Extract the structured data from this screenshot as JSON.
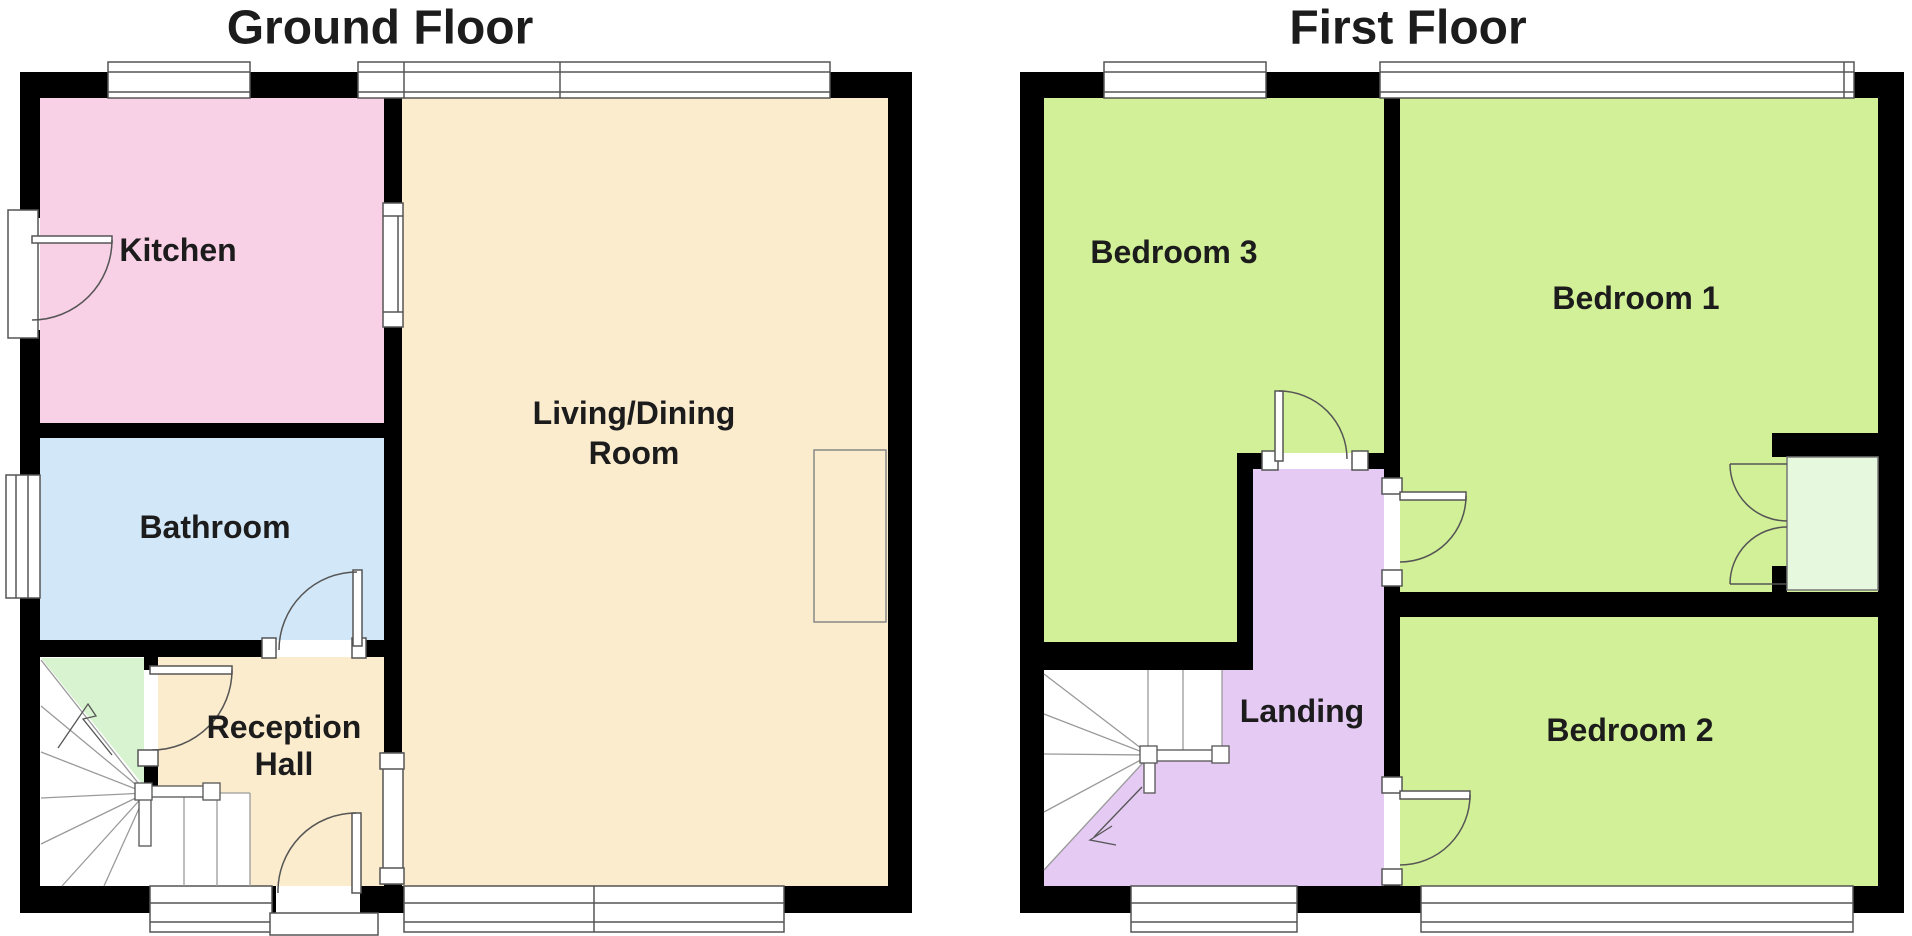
{
  "ground": {
    "title": "Ground Floor",
    "rooms": {
      "kitchen": {
        "label": "Kitchen",
        "color": "#f8d1e7"
      },
      "bathroom": {
        "label": "Bathroom",
        "color": "#d2e7f7"
      },
      "living_dining": {
        "label_line1": "Living/Dining",
        "label_line2": "Room",
        "color": "#fbeccd"
      },
      "reception_hall": {
        "label_line1": "Reception",
        "label_line2": "Hall",
        "color": "#fbeccd"
      }
    },
    "stairs": {
      "understairs_color": "#d8f3d0"
    }
  },
  "first": {
    "title": "First Floor",
    "rooms": {
      "bedroom3": {
        "label": "Bedroom 3",
        "color": "#d2f097"
      },
      "bedroom1": {
        "label": "Bedroom 1",
        "color": "#d2f097"
      },
      "bedroom2": {
        "label": "Bedroom 2",
        "color": "#d2f097"
      },
      "landing": {
        "label": "Landing",
        "color": "#e5caf4"
      }
    },
    "cupboard": {
      "color": "#e6f8de"
    }
  },
  "style": {
    "wall_color": "#000000",
    "line_color": "#555555",
    "tread_color": "#9a9a9a",
    "frame_fill": "#ffffff",
    "text_color": "#1c1c1c",
    "background": "#ffffff"
  }
}
